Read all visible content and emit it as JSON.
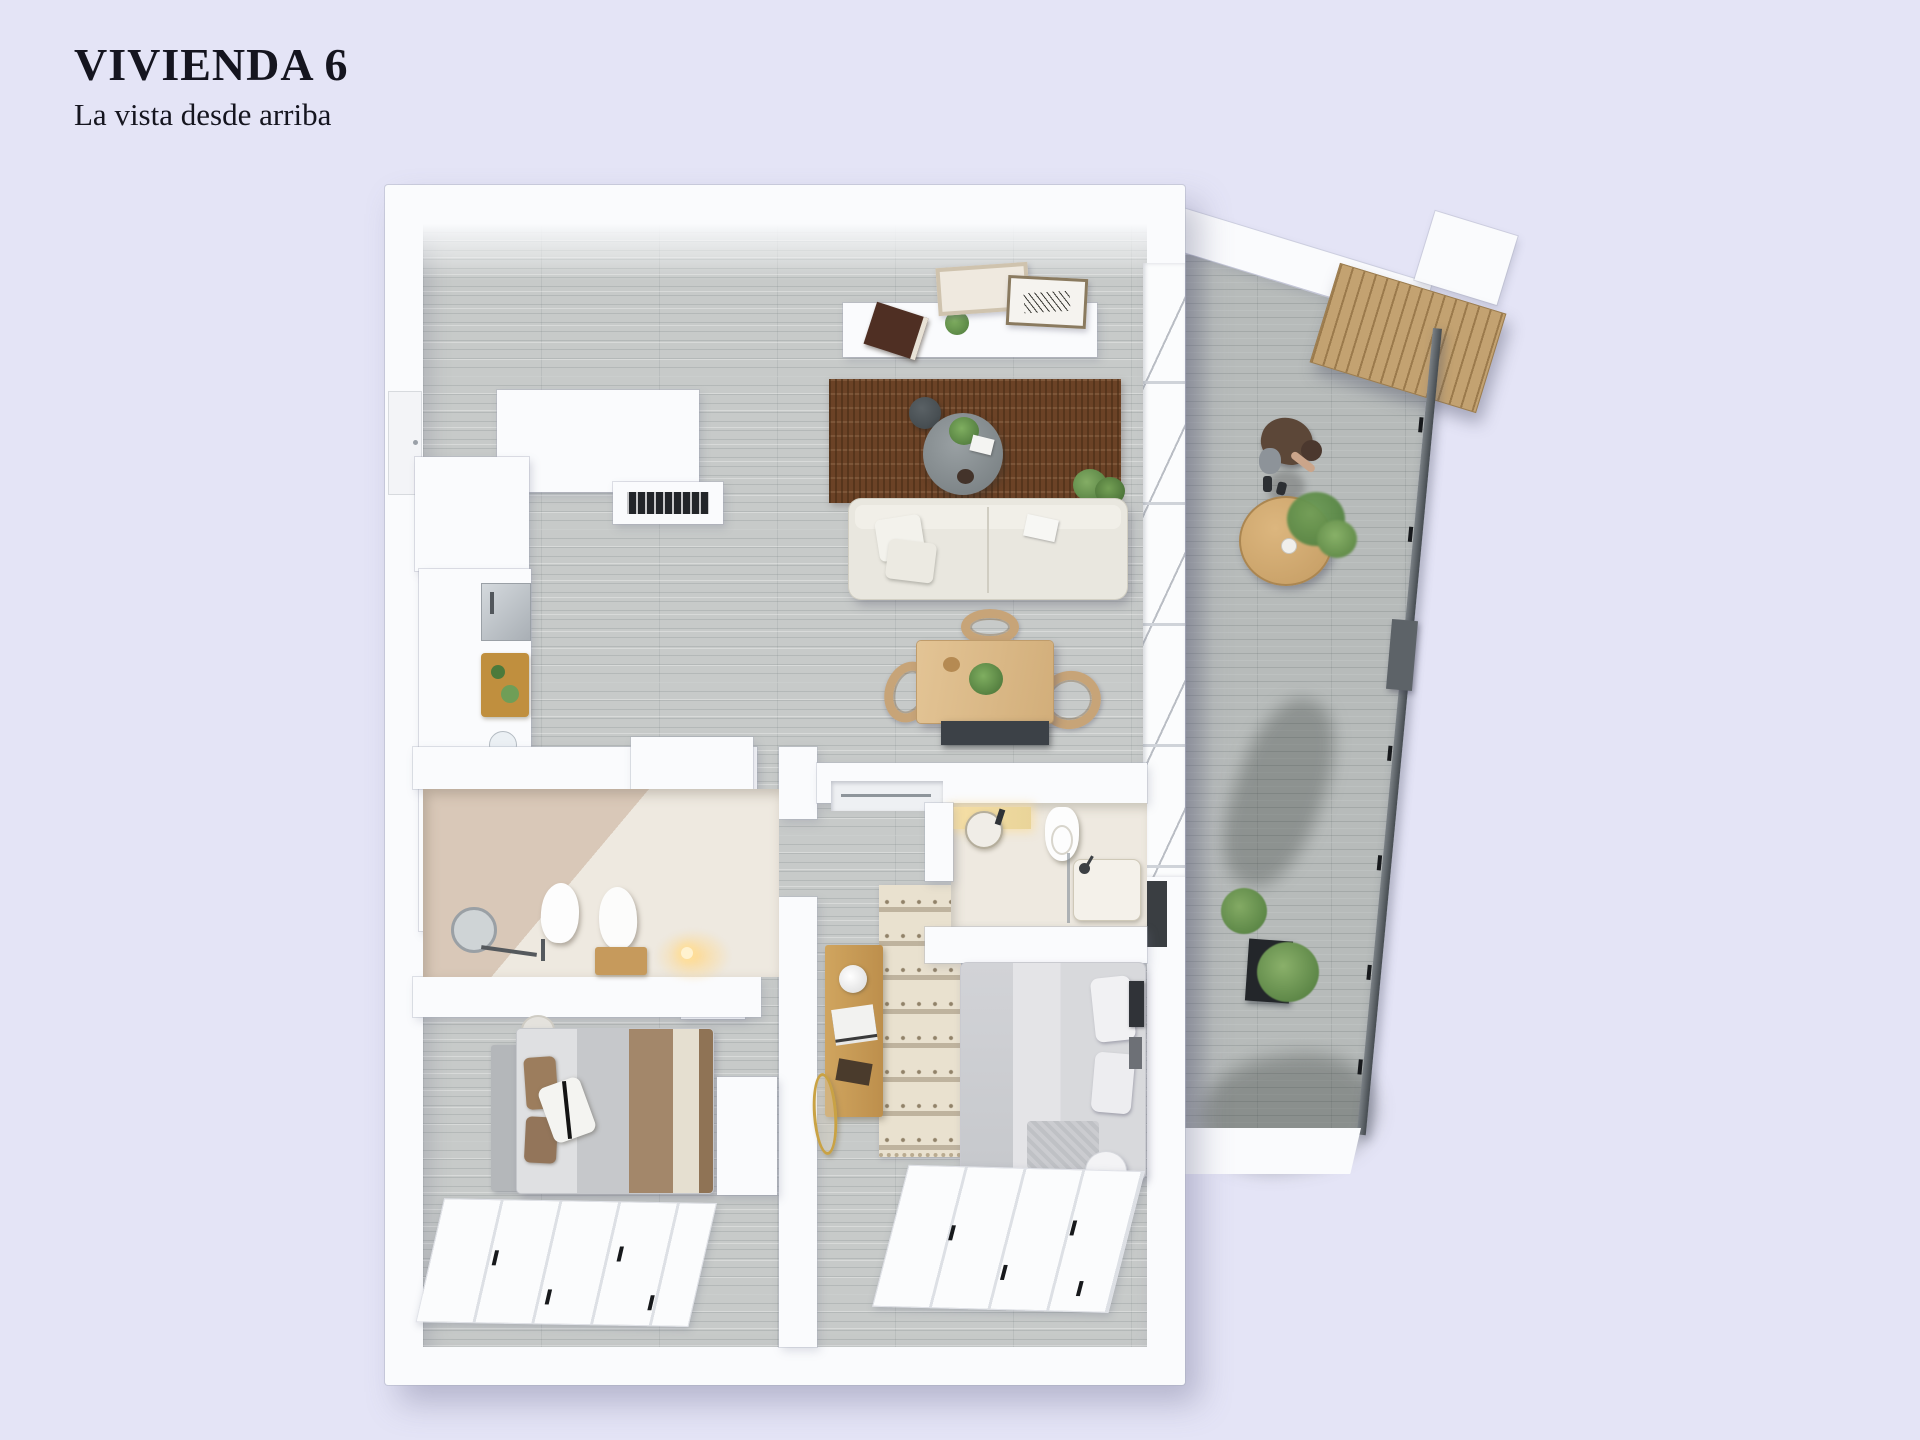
{
  "header": {
    "title": "VIVIENDA 6",
    "subtitle": "La vista desde arriba"
  },
  "plan": {
    "name": "apartment-6-top-down-3d-floor-plan",
    "rooms": [
      "kitchen",
      "living-dining-room",
      "bathroom-1",
      "bathroom-2",
      "bedroom-1",
      "bedroom-2",
      "hallway",
      "balcony"
    ],
    "furniture": [
      "kitchen-counter",
      "cooktop",
      "sink",
      "cutting-board",
      "tall-cabinet",
      "ceiling-vent",
      "wall-shelf",
      "picture-frames",
      "book",
      "plants",
      "brown-rug",
      "coffee-table",
      "side-stool",
      "sofa",
      "pillows",
      "dining-table",
      "dining-chairs",
      "bench",
      "sliding-wardrobes",
      "round-mirror",
      "toilets",
      "washbasin",
      "shower",
      "double-bed",
      "single-bed",
      "desk",
      "gold-mirror",
      "bedside-table",
      "patterned-rug",
      "bistro-table",
      "pergola",
      "glass-railing",
      "person"
    ]
  },
  "colors": {
    "bg": "#e4e4f6",
    "ink": "#15151f",
    "wall": "#fafbfd",
    "floor": "#c7cac9",
    "balcony_floor": "#b7bbba",
    "rug_brown": "#6b4226",
    "rug_brown_dark": "#452a14",
    "sofa": "#e9e7df",
    "sofa_edge": "#d2cfc3",
    "wood_table": "#ddbd92",
    "wood_chair": "#c7a478",
    "coffee_table": "#81898c",
    "stool_dark": "#454c50",
    "bench_dark": "#3c4147",
    "stove": "#17191c",
    "bed_light": "#e2e2e5",
    "blanket_gray": "#c6c8cb",
    "blanket_brown": "#a3876a",
    "blanket_cream": "#e5dfd0",
    "headboard": "#b4b7ba",
    "desk_wood": "#c79a58",
    "rug_pattern_base": "#e9e1cf",
    "rug_pattern_mark": "#9c8e76",
    "bath_beige": "#d9c8b8",
    "bath_floor": "#eee9e0",
    "warm_light": "#ffd98c",
    "pergola": "#c3a271",
    "pergola_line": "#9a7c50",
    "railing": "#5a6065",
    "person_shirt": "#5c4738",
    "person_skin": "#cba58a",
    "person_shorts": "#8d9399",
    "plant_green": "#6f9e57",
    "plant_green_dark": "#4c7a3b",
    "planter_dark": "#23262a",
    "gold": "#c9a244",
    "book_brown": "#4f2f23"
  }
}
